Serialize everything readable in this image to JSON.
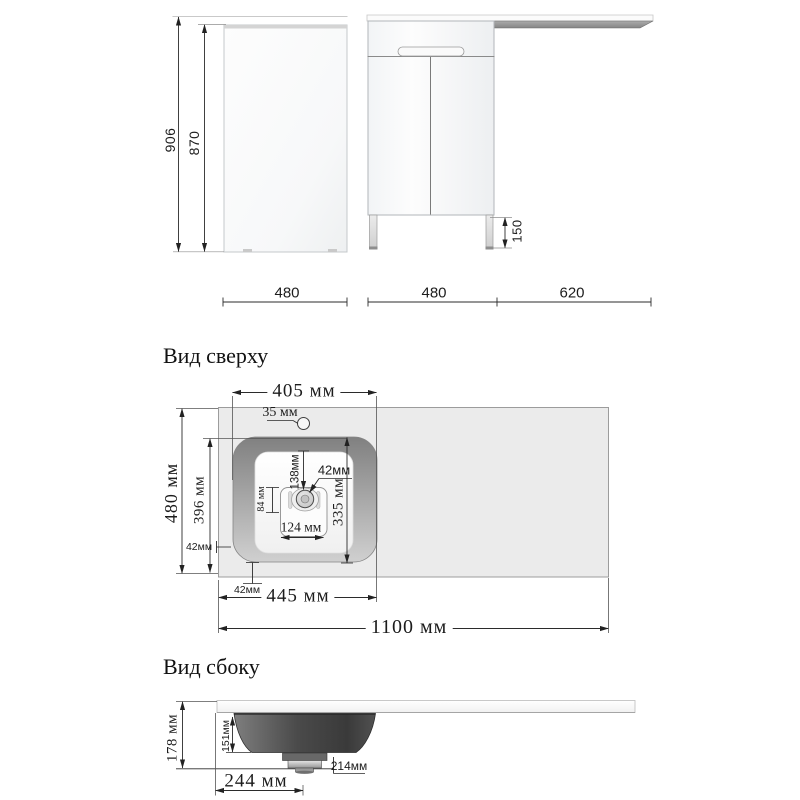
{
  "front_view": {
    "dims": {
      "total_height": "906",
      "cabinet_height": "870",
      "leg_height": "150",
      "side_width": "480",
      "cabinet_width": "480",
      "countertop_overhang": "620"
    }
  },
  "top_view": {
    "title": "Вид сверху",
    "dims": {
      "basin_width": "405 мм",
      "faucet_hole": "35 мм",
      "countertop_depth": "480 мм",
      "basin_depth_outer": "396 мм",
      "side_gap": "42мм",
      "drain_offset_top": "138мм",
      "drain_hole": "42мм",
      "plate_height": "84 мм",
      "basin_depth_inner": "335 мм",
      "plate_width": "124 мм",
      "front_gap": "42мм",
      "basin_outer_width": "445 мм",
      "countertop_width": "1100 мм"
    }
  },
  "side_view": {
    "title": "Вид сбоку",
    "dims": {
      "total_height": "178 мм",
      "basin_height": "151мм",
      "drain_offset": "214мм",
      "basin_bottom_width": "244 мм"
    }
  },
  "colors": {
    "line": "#2b2b2b",
    "countertop_fill": "#ebebeb",
    "basin_dark": "#4a4a4a"
  }
}
